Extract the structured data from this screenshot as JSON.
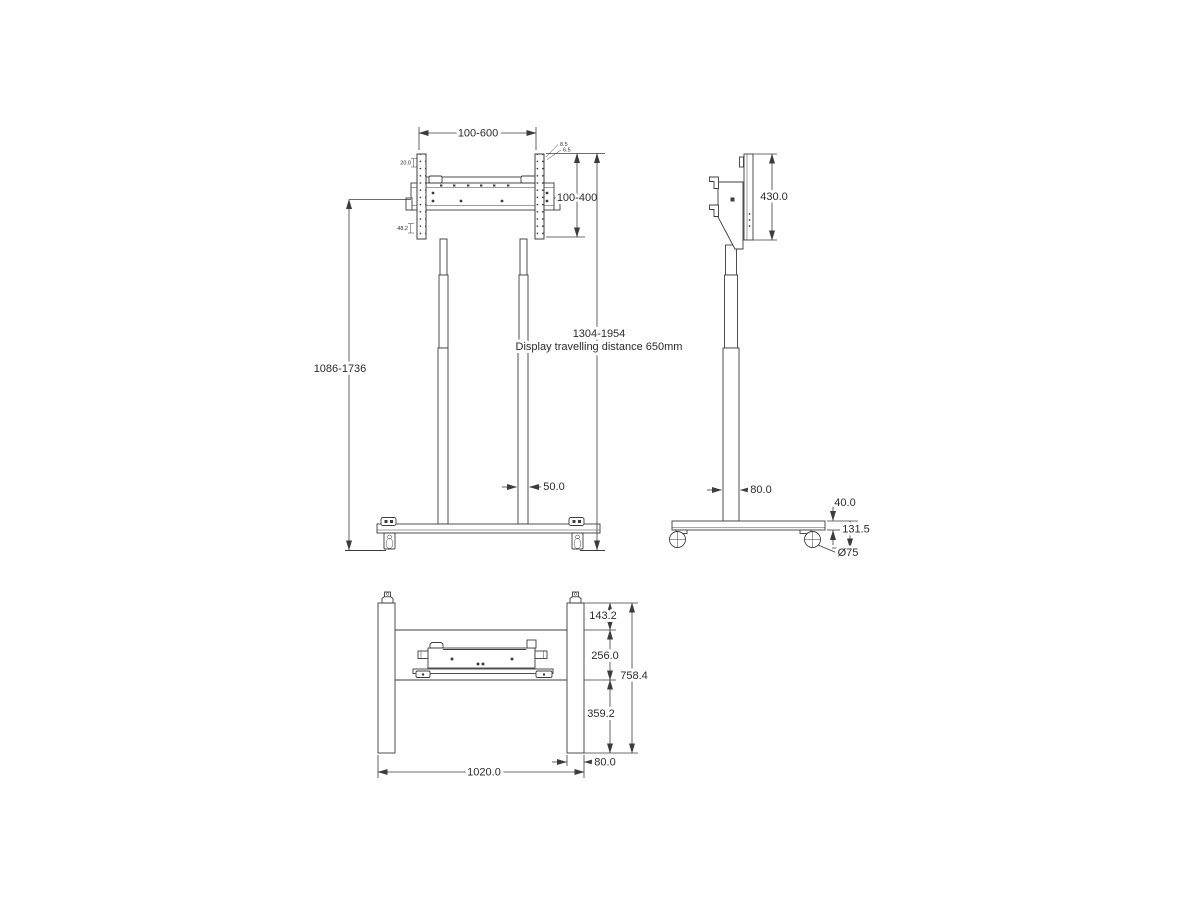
{
  "colors": {
    "line": "#3c3c3c",
    "text": "#2b2b2b",
    "background": "#ffffff"
  },
  "front_view": {
    "dims": {
      "bracket_width_range": "100-600",
      "bracket_height_range": "100-400",
      "lift_height_range": "1086-1736",
      "overall_height_range": "1304-1954",
      "travel_note": "Display travelling distance 650mm",
      "column_width": "50.0",
      "strip_pitch": "20.0",
      "strip_offset": "48.2",
      "hook_note_upper": "8.5",
      "hook_note_lower": "6.5"
    }
  },
  "side_view": {
    "dims": {
      "plate_height": "430.0",
      "column_depth": "80.0",
      "base_thickness": "40.0",
      "base_height": "131.5",
      "caster_diameter": "Ø75"
    }
  },
  "top_view": {
    "dims": {
      "front_offset": "143.2",
      "crossbar_depth": "256.0",
      "overall_depth": "758.4",
      "rear_offset": "359.2",
      "foot_width": "80.0",
      "overall_width": "1020.0"
    }
  }
}
